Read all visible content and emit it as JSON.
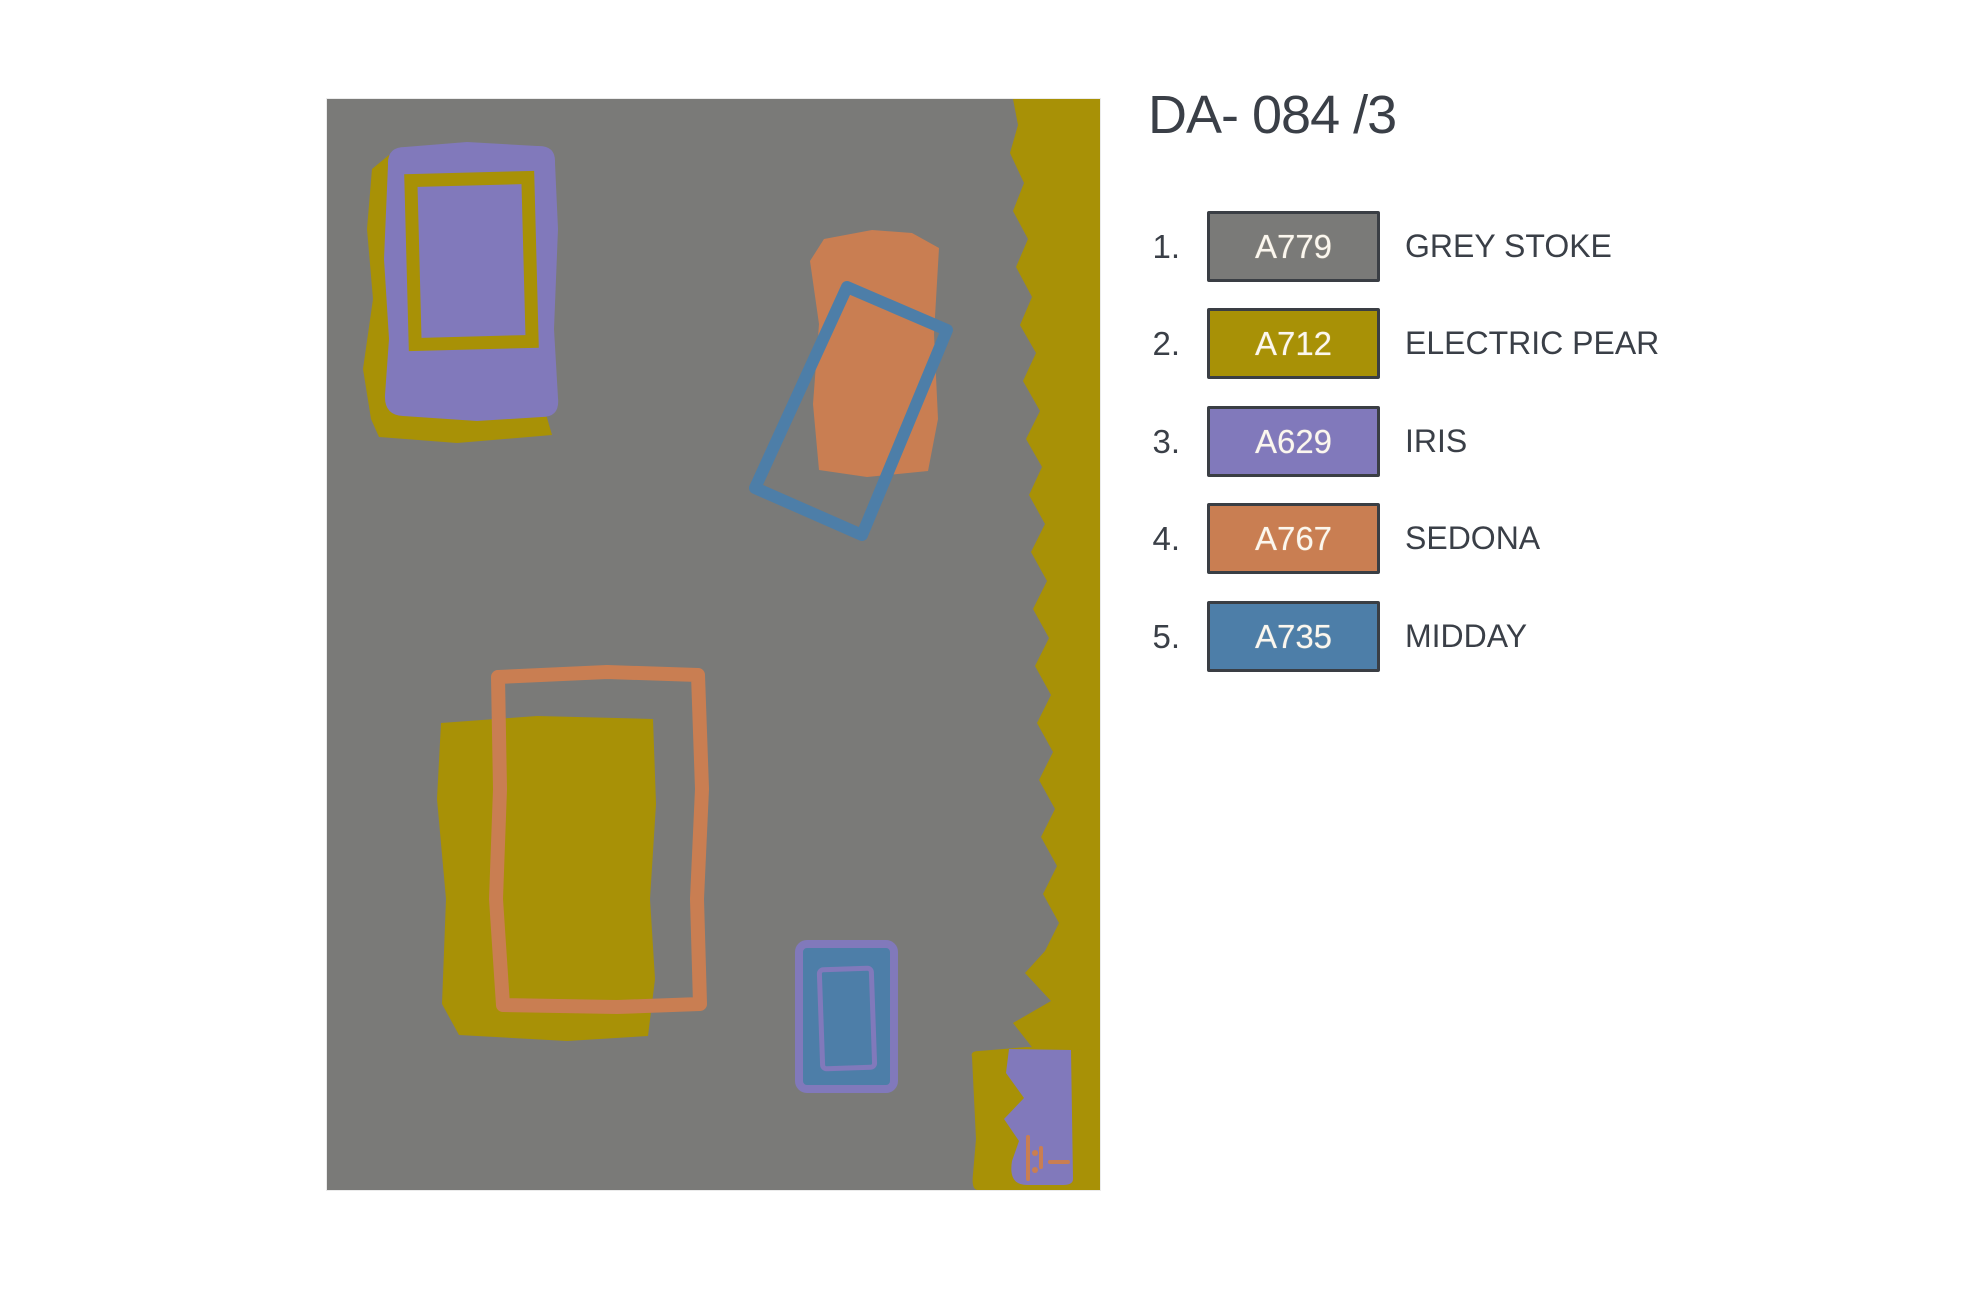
{
  "title": "DA- 084 /3",
  "palette": {
    "grey_stoke": "#7a7a78",
    "electric_pear": "#a89106",
    "iris": "#8179bb",
    "sedona": "#c97e52",
    "midday": "#4d7ea8",
    "text_dark": "#3a3f47",
    "swatch_border": "#3a3e44",
    "swatch_text": "#fbf7ef"
  },
  "legend": {
    "items": [
      {
        "number": "1.",
        "code": "A779",
        "name": "GREY STOKE",
        "color": "#7a7a78"
      },
      {
        "number": "2.",
        "code": "A712",
        "name": "ELECTRIC PEAR",
        "color": "#a89106"
      },
      {
        "number": "3.",
        "code": "A629",
        "name": "IRIS",
        "color": "#8179bb"
      },
      {
        "number": "4.",
        "code": "A767",
        "name": "SEDONA",
        "color": "#c97e52"
      },
      {
        "number": "5.",
        "code": "A735",
        "name": "MIDDAY",
        "color": "#4d7ea8"
      }
    ]
  }
}
